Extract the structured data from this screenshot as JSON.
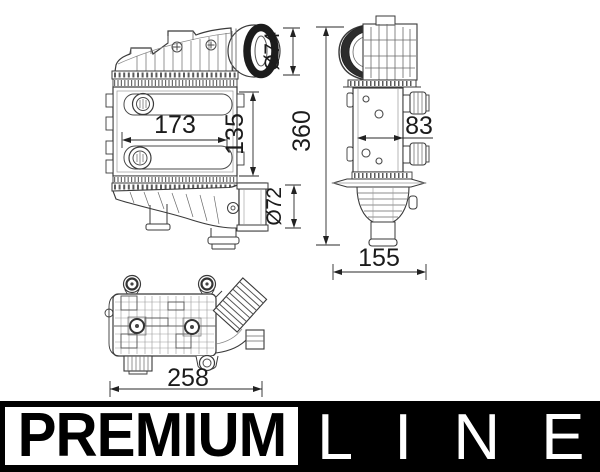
{
  "drawing": {
    "front_view": {
      "core_width": "173",
      "core_height": "135",
      "inlet_diameter": "Ø74",
      "outlet_diameter": "Ø72"
    },
    "side_view": {
      "overall_height": "360",
      "core_depth": "83",
      "overall_depth": "155"
    },
    "top_view": {
      "overall_length": "258"
    }
  },
  "banner": {
    "premium_label": "PREMIUM",
    "line_label": "LINE"
  },
  "colors": {
    "line_art": "#3a3a3a",
    "detail_line": "#777777",
    "dimension_text": "#1b1b1b",
    "banner_background": "#000000",
    "banner_foreground": "#ffffff"
  }
}
